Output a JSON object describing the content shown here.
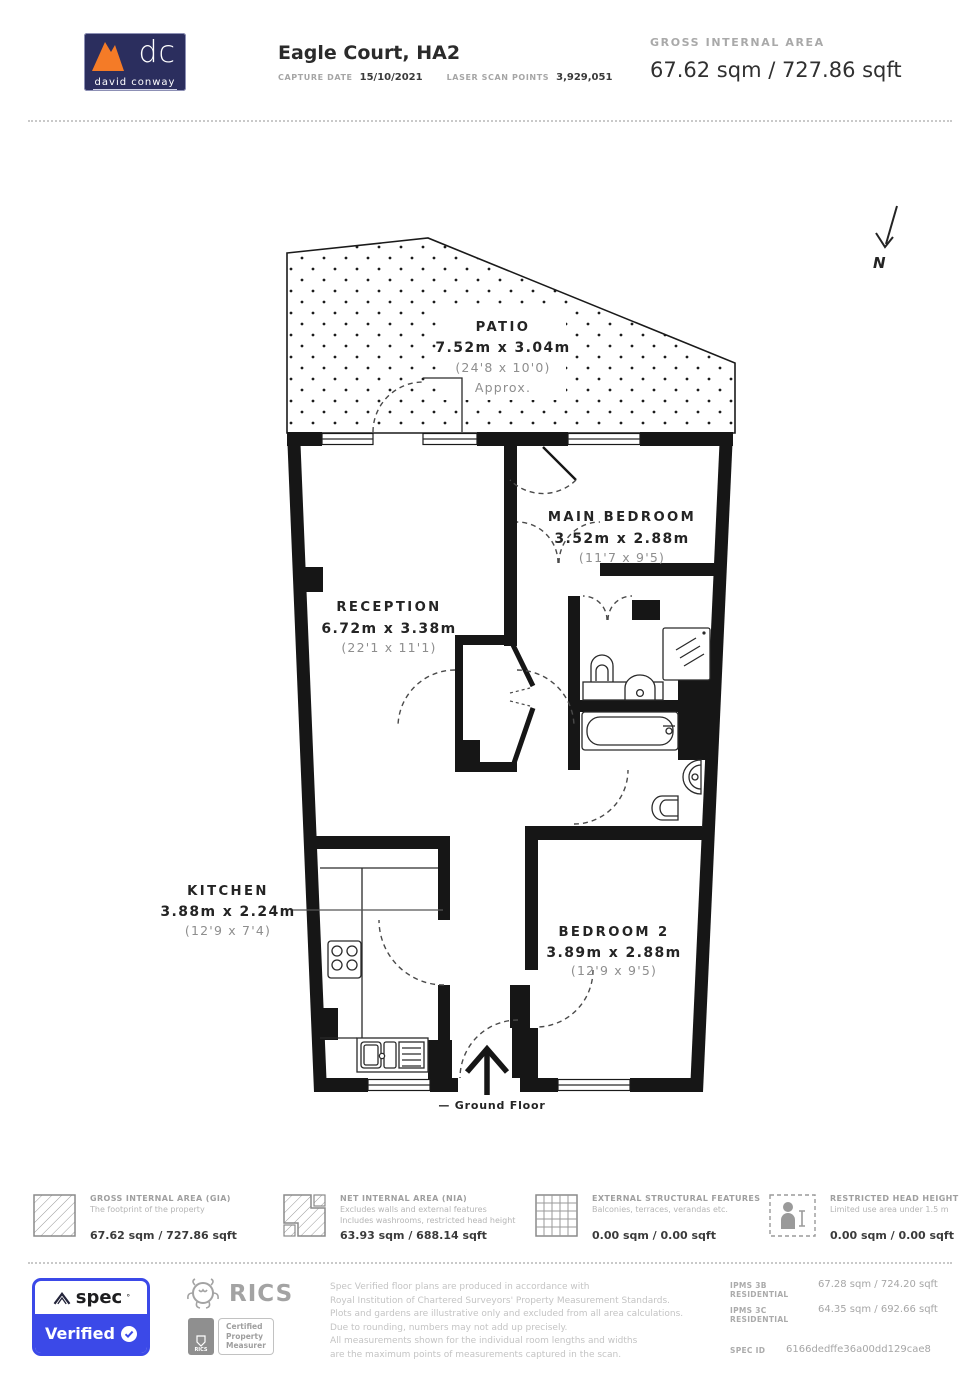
{
  "header": {
    "logo": {
      "monogram": "dc",
      "company": "david conway"
    },
    "title": "Eagle Court, HA2",
    "capture_date_label": "CAPTURE DATE",
    "capture_date": "15/10/2021",
    "laser_label": "LASER SCAN POINTS",
    "laser_value": "3,929,051",
    "gia_label": "GROSS INTERNAL AREA",
    "gia_value": "67.62 sqm / 727.86 sqft"
  },
  "plan": {
    "north": "N",
    "ground_floor": "— Ground Floor",
    "patio": {
      "name": "PATIO",
      "metric": "7.52m x 3.04m",
      "imperial": "(24'8 x 10'0)",
      "note": "Approx."
    },
    "main_bedroom": {
      "name": "MAIN BEDROOM",
      "metric": "3.52m x 2.88m",
      "imperial": "(11'7 x 9'5)"
    },
    "reception": {
      "name": "RECEPTION",
      "metric": "6.72m x 3.38m",
      "imperial": "(22'1 x 11'1)"
    },
    "kitchen": {
      "name": "KITCHEN",
      "metric": "3.88m x 2.24m",
      "imperial": "(12'9 x 7'4)"
    },
    "bedroom2": {
      "name": "BEDROOM 2",
      "metric": "3.89m x 2.88m",
      "imperial": "(12'9 x 9'5)"
    }
  },
  "legend": {
    "gia": {
      "title": "GROSS INTERNAL AREA (GIA)",
      "desc1": "The footprint of the property",
      "value": "67.62 sqm / 727.86 sqft"
    },
    "nia": {
      "title": "NET INTERNAL AREA (NIA)",
      "desc1": "Excludes walls and external features",
      "desc2": "Includes washrooms, restricted head height",
      "value": "63.93 sqm / 688.14 sqft"
    },
    "external": {
      "title": "EXTERNAL STRUCTURAL FEATURES",
      "desc1": "Balconies, terraces, verandas etc.",
      "value": "0.00 sqm / 0.00 sqft"
    },
    "restricted": {
      "title": "RESTRICTED HEAD HEIGHT",
      "desc1": "Limited use area under 1.5 m",
      "value": "0.00 sqm / 0.00 sqft"
    }
  },
  "footer": {
    "spec_badge": {
      "brand": "spec",
      "mark": "°",
      "verified": "Verified"
    },
    "rics": {
      "name": "RICS",
      "mini": "RICS",
      "cert1": "Certified",
      "cert2": "Property",
      "cert3": "Measurer"
    },
    "disclaimer": [
      "Spec Verified floor plans are produced in accordance with",
      "Royal Institution of Chartered Surveyors' Property Measurement Standards.",
      "Plots and gardens are illustrative only and excluded from all area calculations.",
      "Due to rounding, numbers may not add up precisely.",
      "All measurements shown for the individual room lengths and widths",
      "are the maximum points of measurements captured in the scan."
    ],
    "ipms": [
      {
        "label": "IPMS 3B RESIDENTIAL",
        "value": "67.28 sqm / 724.20 sqft"
      },
      {
        "label": "IPMS 3C RESIDENTIAL",
        "value": "64.35 sqm / 692.66 sqft"
      }
    ],
    "spec_id_label": "SPEC ID",
    "spec_id": "6166dedffe36a00dd129cae8"
  },
  "colors": {
    "accent_blue": "#3b49e8",
    "logo_navy": "#2b2e5e",
    "logo_orange": "#f47b27",
    "wall": "#161616"
  }
}
